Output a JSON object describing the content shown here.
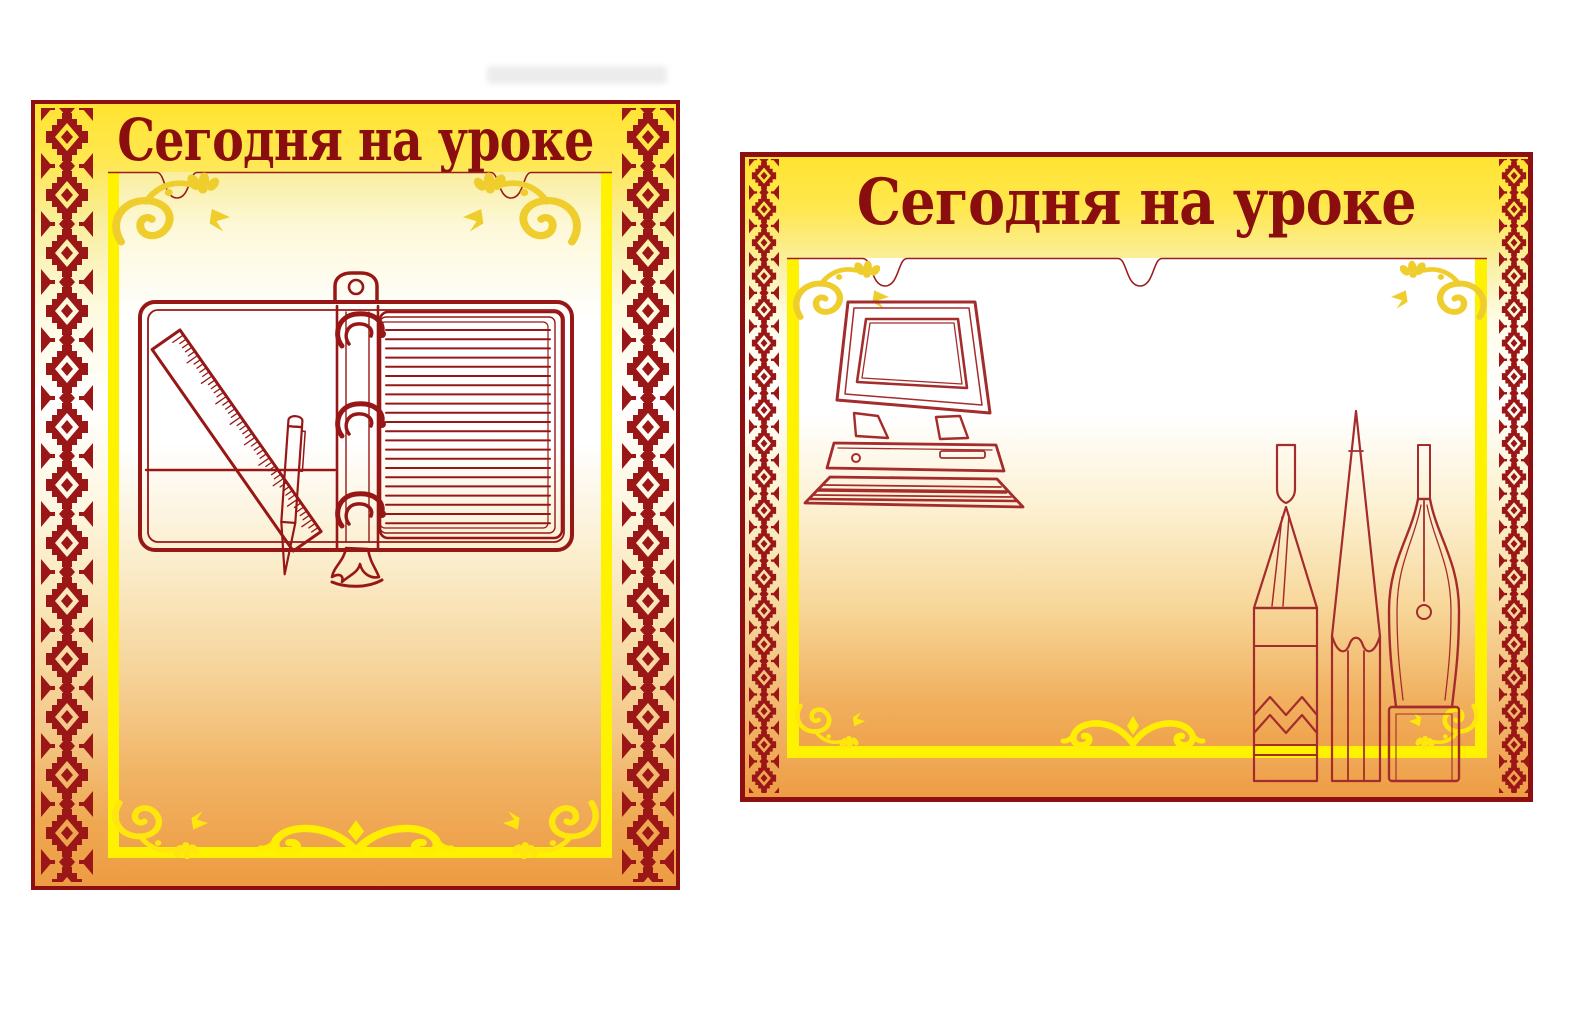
{
  "page": {
    "background_color": "#FFFFFF",
    "description": "Two classroom information stand posters with empty transparent pockets"
  },
  "colors": {
    "border_dark_red": "#8E0F0F",
    "title_red": "#8A0E0E",
    "ornament_red": "#9B1616",
    "line_art_red": "#971717",
    "line_art_light_red": "#A52C2C",
    "pocket_border_yellow": "#FFF200",
    "flourish_gold": "#EFCD2C",
    "flourish_yellow": "#FFE60C",
    "gradient_top_yellow": "#FFE431",
    "gradient_bottom_orange": "#ED9C43"
  },
  "panels": [
    {
      "id": "left-stand",
      "title": "Сегодня на уроке",
      "orientation": "portrait",
      "border_ornament": "slavic-diamond-pattern",
      "pocket": {
        "type": "empty-transparent-pocket",
        "notches": 2,
        "content": ""
      },
      "artwork": {
        "name": "open-ring-binder-with-ruler-and-pen",
        "items": [
          "ring-binder-notebook",
          "ruler",
          "ballpoint-pen"
        ]
      }
    },
    {
      "id": "right-stand",
      "title": "Сегодня на уроке",
      "orientation": "landscape",
      "border_ornament": "slavic-diamond-pattern",
      "pocket": {
        "type": "empty-transparent-pocket",
        "notches": 2,
        "content": ""
      },
      "artwork": {
        "name": "computer-and-writing-tools",
        "items": [
          "desktop-computer",
          "ballpoint-pen",
          "pencil",
          "fountain-pen-nib"
        ]
      }
    }
  ]
}
